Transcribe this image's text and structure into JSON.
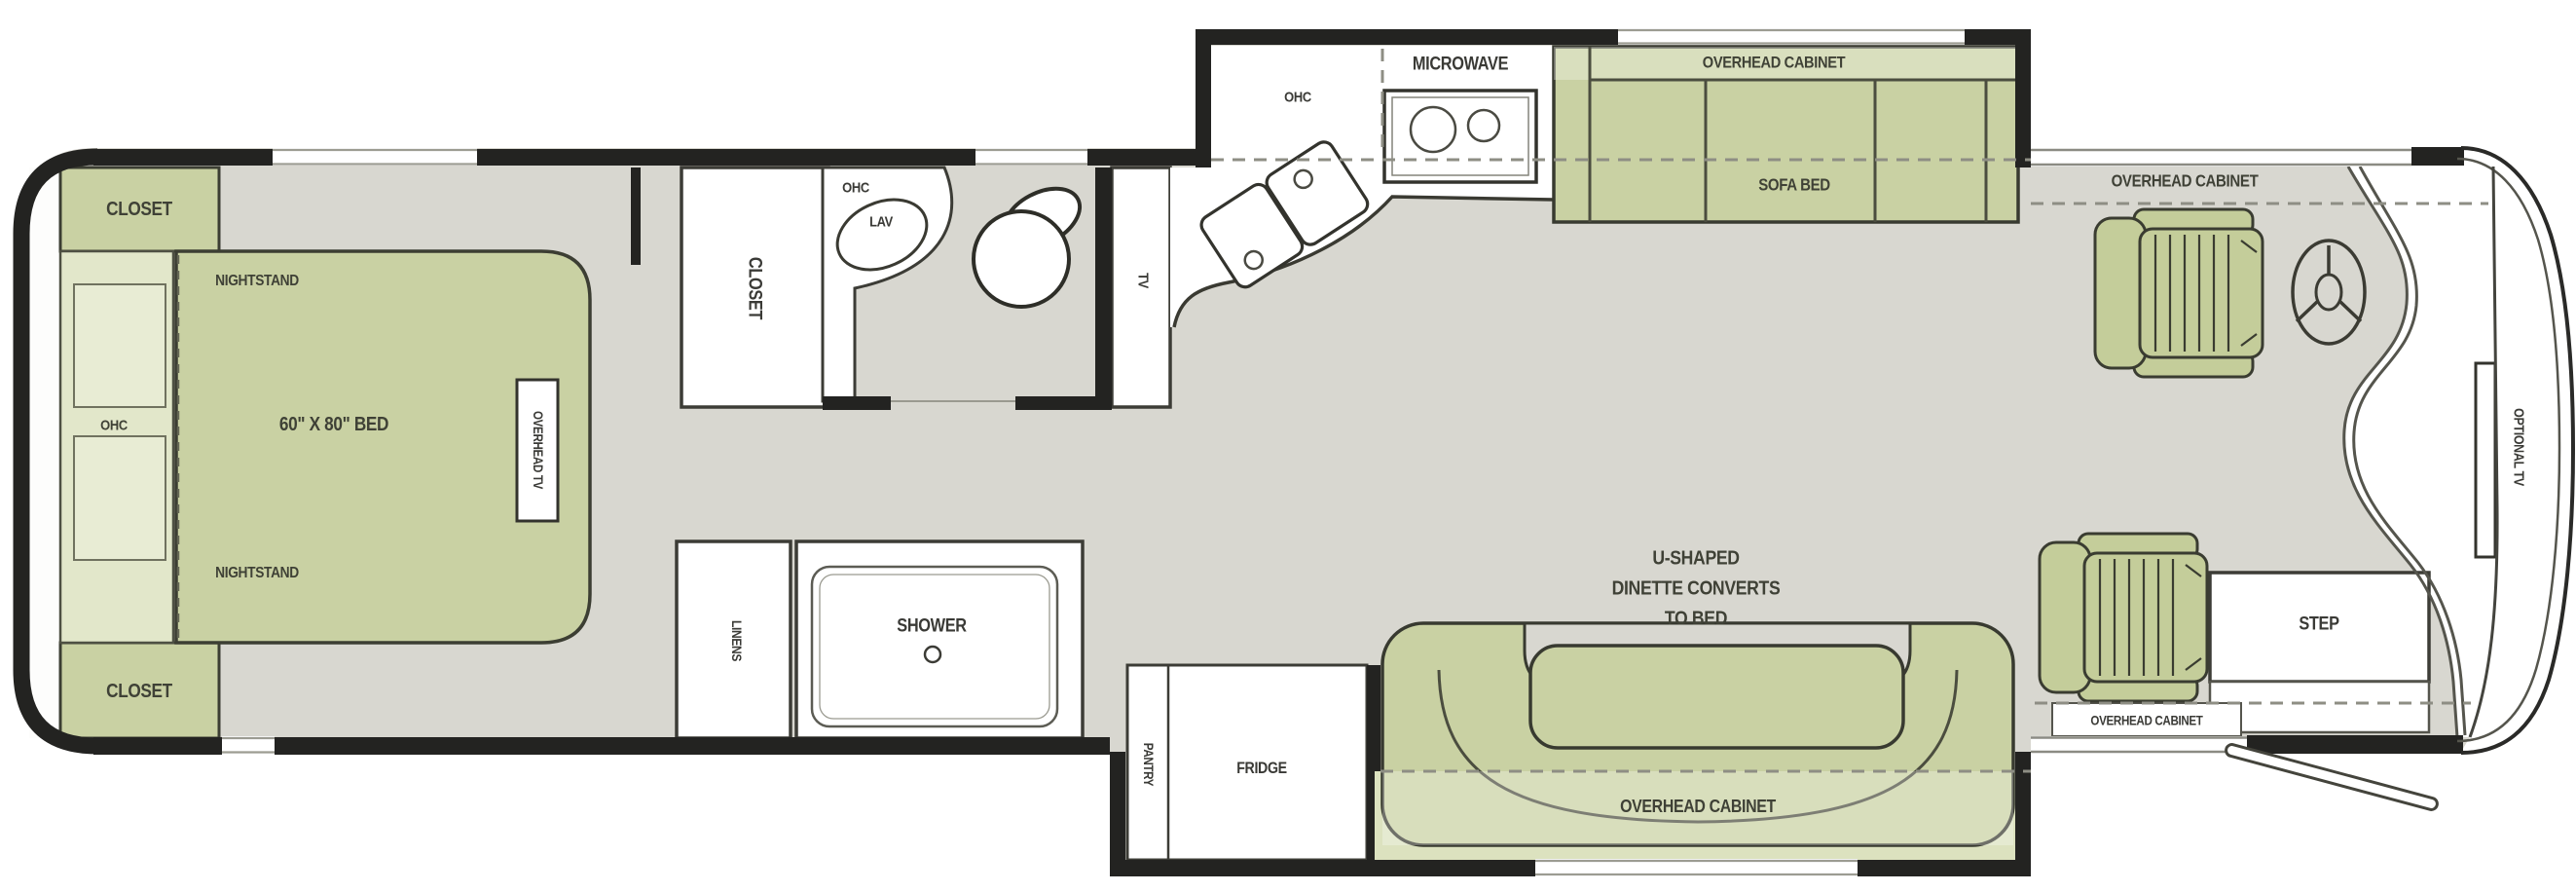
{
  "floorplan": {
    "bedroom": {
      "closet_top": "CLOSET",
      "nightstand_top": "NIGHTSTAND",
      "ohc": "OHC",
      "bed": "60\" X 80\" BED",
      "overhead_tv": "OVERHEAD TV",
      "nightstand_bottom": "NIGHTSTAND",
      "closet_bottom": "CLOSET"
    },
    "bath": {
      "closet": "CLOSET",
      "ohc": "OHC",
      "lav": "LAV",
      "tv": "TV",
      "linens": "LINENS",
      "shower": "SHOWER"
    },
    "kitchen": {
      "ohc": "OHC",
      "microwave": "MICROWAVE",
      "overhead_cabinet": "OVERHEAD CABINET",
      "sofa_bed": "SOFA BED",
      "pantry": "PANTRY",
      "fridge": "FRIDGE"
    },
    "dinette": {
      "label_line1": "U-SHAPED",
      "label_line2": "DINETTE CONVERTS",
      "label_line3": "TO BED",
      "overhead_cabinet": "OVERHEAD CABINET"
    },
    "cockpit": {
      "overhead_cabinet_top": "OVERHEAD CABINET",
      "overhead_cabinet_bottom": "OVERHEAD CABINET",
      "step": "STEP",
      "optional_tv": "OPTIONAL TV"
    }
  },
  "palette": {
    "floor_gray": "#d8d7d0",
    "furniture_green": "#c9d1a3",
    "cabinet_light_green": "#e2e7ca",
    "wall_black": "#232321",
    "label_color": "#3f4136",
    "white": "#ffffff"
  }
}
